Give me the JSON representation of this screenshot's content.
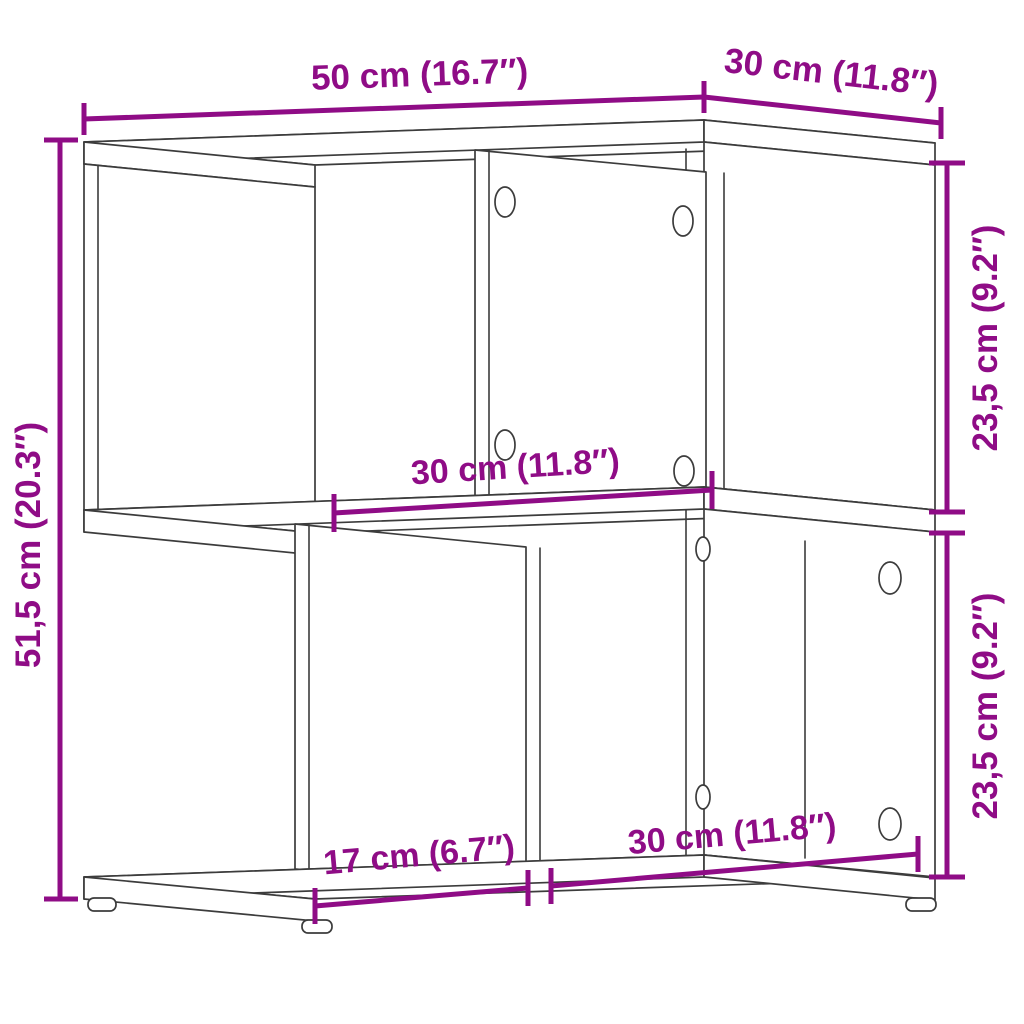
{
  "diagram": {
    "kind": "furniture-dimension-diagram",
    "subject": "two-tier offset shelf side table, line drawing in perspective",
    "colors": {
      "dimension_accent": "#8f0c86",
      "outline": "#3c3c3c",
      "background": "#ffffff"
    },
    "labels": {
      "top_width": "50 cm (16.7″)",
      "top_depth": "30 cm (11.8″)",
      "overall_height": "51,5 cm (20.3″)",
      "upper_inner_height": "23,5 cm (9.2″)",
      "lower_inner_height": "23,5 cm (9.2″)",
      "upper_inner_width": "30 cm (11.8″)",
      "lower_left_inset": "17 cm (6.7″)",
      "lower_inner_width": "30 cm (11.8″)"
    },
    "measurements": [
      {
        "name": "overall width",
        "cm": 50,
        "inch": 16.7
      },
      {
        "name": "overall depth",
        "cm": 30,
        "inch": 11.8
      },
      {
        "name": "overall height",
        "cm": 51.5,
        "inch": 20.3
      },
      {
        "name": "upper compartment height",
        "cm": 23.5,
        "inch": 9.2
      },
      {
        "name": "lower compartment height",
        "cm": 23.5,
        "inch": 9.2
      },
      {
        "name": "upper compartment width",
        "cm": 30,
        "inch": 11.8
      },
      {
        "name": "lower left inset",
        "cm": 17,
        "inch": 6.7
      },
      {
        "name": "lower compartment width",
        "cm": 30,
        "inch": 11.8
      }
    ]
  }
}
